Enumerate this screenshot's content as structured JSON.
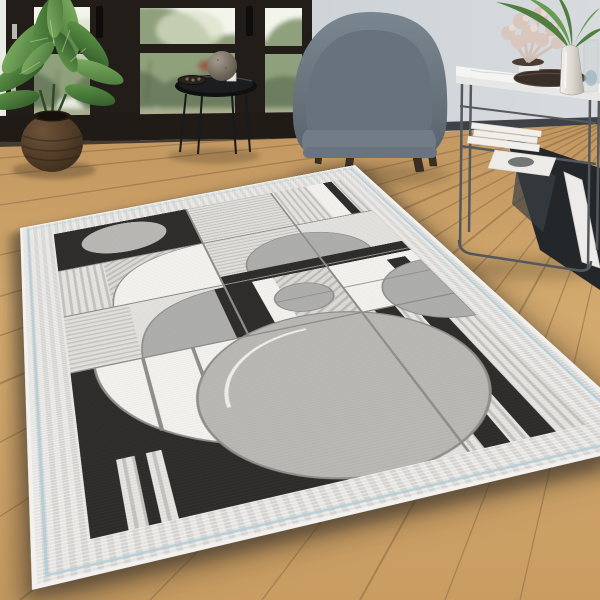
{
  "scene": {
    "type": "interior product photo",
    "subject": "geometric art-deco area rug in grey, black and white",
    "room": "living room with wooden floor, black-framed glass doors, armchair and console table"
  },
  "palette": {
    "wall": "#c6cdd2",
    "wall_light": "#d6dadd",
    "door_frame": "#221d19",
    "glass_light": "#e9ece2",
    "garden_green": "#8fa07c",
    "garden_green_dark": "#6c7e5e",
    "wood_floor": "#cda468",
    "wood_gap": "#8a6a44",
    "rug_border": "#dcdbd8",
    "rug_pinstripe": "#aecdd8",
    "rug_black": "#2d2c2a",
    "rug_white": "#f3f2ef",
    "rug_gray": "#b9b8b5",
    "chair_fabric": "#6e7983",
    "chair_leg_wood": "#3a2d23",
    "console_metal": "#55595d",
    "marble_top": "#f3f3f2",
    "coral_pink": "#d9c6bd",
    "palm_green": "#517e40",
    "plant_pot": "#4a3828"
  },
  "objects": [
    {
      "id": "window-doors",
      "label": "black framed glass doors with garden view"
    },
    {
      "id": "potted-plant",
      "label": "green houseplant in round brown pot"
    },
    {
      "id": "side-table",
      "label": "black round tray side table with sphere vase"
    },
    {
      "id": "armchair",
      "label": "grey upholstered barrel armchair with wooden legs"
    },
    {
      "id": "console-table",
      "label": "white marble console table with metal frame, books and decor"
    },
    {
      "id": "coral-decor",
      "label": "pink coral ornament"
    },
    {
      "id": "palm-vase",
      "label": "silver vase with palm leaves"
    },
    {
      "id": "area-rug",
      "label": "grey geometric patterned area rug"
    }
  ],
  "rug": {
    "field_size": {
      "w": 332,
      "h": 492
    },
    "colors": {
      "base": "#e3e2df",
      "white": "#f3f2ef",
      "black": "#2d2c2a",
      "gray1": "#b9b8b5",
      "gray2": "#aeaeac",
      "line": "#8f8e89",
      "whiteline": "#f0efec",
      "pv": "@pv",
      "ph": "@ph",
      "pd": "@pd"
    },
    "pattern": [
      {
        "t": "rect",
        "x": 0,
        "y": 0,
        "w": 332,
        "h": 492,
        "f": "base"
      },
      {
        "t": "rect",
        "x": 150,
        "y": 0,
        "w": 99,
        "h": 98,
        "f": "ph"
      },
      {
        "t": "rect",
        "x": 249,
        "y": 0,
        "w": 42,
        "h": 98,
        "f": "pv"
      },
      {
        "t": "rect",
        "x": 291,
        "y": 0,
        "w": 20,
        "h": 98,
        "f": "white"
      },
      {
        "t": "rect",
        "x": 311,
        "y": 0,
        "w": 10,
        "h": 98,
        "f": "black"
      },
      {
        "t": "rect",
        "x": 321,
        "y": 0,
        "w": 11,
        "h": 98,
        "f": "pv"
      },
      {
        "t": "rect",
        "x": 0,
        "y": 0,
        "w": 150,
        "h": 98,
        "f": "black"
      },
      {
        "t": "ellipse",
        "cx": 74,
        "cy": 44,
        "rx": 46,
        "ry": 38,
        "f": "gray1"
      },
      {
        "t": "rect",
        "x": 0,
        "y": 98,
        "w": 46,
        "h": 99,
        "f": "pv"
      },
      {
        "t": "rect",
        "x": 46,
        "y": 98,
        "w": 104,
        "h": 99,
        "f": "pd"
      },
      {
        "t": "path",
        "d": "M46,197 Q52,104 150,98 L150,197 Z",
        "f": "white",
        "s": "line",
        "sw": 1.5
      },
      {
        "t": "rect",
        "x": 150,
        "y": 98,
        "w": 99,
        "h": 99,
        "f": "ph"
      },
      {
        "t": "rect",
        "x": 0,
        "y": 197,
        "w": 60,
        "h": 98,
        "f": "ph"
      },
      {
        "t": "path",
        "d": "M60,295 Q64,206 150,202 L150,295 Z",
        "f": "gray2",
        "s": "line",
        "sw": 1.5
      },
      {
        "t": "path",
        "d": "M178,180 A61,61 0 0 1 300,180 Z",
        "f": "gray2",
        "s": "line",
        "sw": 1.5
      },
      {
        "t": "rect",
        "x": 150,
        "y": 180,
        "w": 182,
        "h": 22,
        "f": "black"
      },
      {
        "t": "rect",
        "x": 150,
        "y": 202,
        "w": 99,
        "h": 93,
        "f": "pd"
      },
      {
        "t": "rect",
        "x": 249,
        "y": 202,
        "w": 83,
        "h": 93,
        "f": "white"
      },
      {
        "t": "rect",
        "x": 304,
        "y": 212,
        "w": 18,
        "h": 48,
        "f": "black"
      },
      {
        "t": "rect",
        "x": 140,
        "y": 202,
        "w": 36,
        "h": 93,
        "f": "black"
      },
      {
        "t": "rect",
        "x": 176,
        "y": 202,
        "w": 20,
        "h": 93,
        "f": "white"
      },
      {
        "t": "circle",
        "cx": 212,
        "cy": 249,
        "r": 26,
        "f": "gray2",
        "s": "line",
        "sw": 1.5
      },
      {
        "t": "line",
        "x1": 186,
        "y1": 249,
        "x2": 238,
        "y2": 249,
        "s": "line",
        "sw": 1.5
      },
      {
        "t": "rect",
        "x": 0,
        "y": 295,
        "w": 170,
        "h": 197,
        "f": "black"
      },
      {
        "t": "path",
        "d": "M170,295 L20,295 A150,150 0 0 0 170,445 Z",
        "f": "white",
        "s": "line",
        "sw": 2
      },
      {
        "t": "line",
        "x1": 60,
        "y1": 295,
        "x2": 60,
        "y2": 398,
        "s": "line",
        "sw": 3
      },
      {
        "t": "line",
        "x1": 102,
        "y1": 295,
        "x2": 102,
        "y2": 430,
        "s": "line",
        "sw": 3
      },
      {
        "t": "line",
        "x1": 144,
        "y1": 295,
        "x2": 144,
        "y2": 444,
        "s": "line",
        "sw": 3
      },
      {
        "t": "rect",
        "x": 249,
        "y": 295,
        "w": 83,
        "h": 197,
        "f": "pv"
      },
      {
        "t": "rect",
        "x": 260,
        "y": 295,
        "w": 18,
        "h": 197,
        "f": "black"
      },
      {
        "t": "rect",
        "x": 292,
        "y": 295,
        "w": 18,
        "h": 197,
        "f": "black"
      },
      {
        "t": "circle",
        "cx": 197,
        "cy": 388,
        "r": 107,
        "f": "gray1",
        "s": "line",
        "sw": 2
      },
      {
        "t": "path",
        "d": "M112,388 A85,85 0 0 1 197,303",
        "f": "none",
        "s": "whiteline",
        "sw": 3
      },
      {
        "t": "path",
        "d": "M332,225 A55,55 0 0 0 332,335 Z",
        "f": "gray2",
        "s": "line",
        "sw": 1.5
      },
      {
        "t": "rect",
        "x": 24,
        "y": 420,
        "w": 13,
        "h": 72,
        "f": "pv"
      },
      {
        "t": "rect",
        "x": 45,
        "y": 420,
        "w": 11,
        "h": 72,
        "f": "pv"
      },
      {
        "t": "line",
        "x1": 150,
        "y1": 0,
        "x2": 150,
        "y2": 295,
        "s": "line",
        "sw": 2
      },
      {
        "t": "line",
        "x1": 249,
        "y1": 0,
        "x2": 249,
        "y2": 492,
        "s": "line",
        "sw": 2
      },
      {
        "t": "line",
        "x1": 0,
        "y1": 98,
        "x2": 332,
        "y2": 98,
        "s": "line",
        "sw": 2
      },
      {
        "t": "line",
        "x1": 0,
        "y1": 197,
        "x2": 332,
        "y2": 197,
        "s": "line",
        "sw": 2
      },
      {
        "t": "line",
        "x1": 0,
        "y1": 295,
        "x2": 332,
        "y2": 295,
        "s": "line",
        "sw": 2
      },
      {
        "t": "line",
        "x1": 249,
        "y1": 247,
        "x2": 332,
        "y2": 247,
        "s": "line",
        "sw": 1.5
      }
    ]
  }
}
